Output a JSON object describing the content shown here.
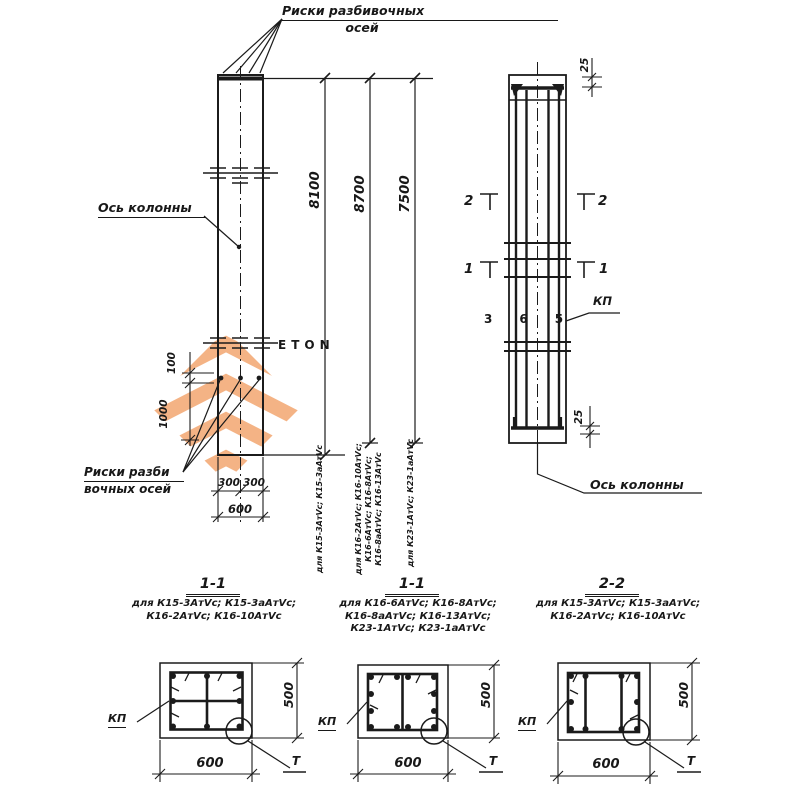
{
  "watermark": {
    "brand_word": "ETON",
    "brand_number": "365",
    "orange": "#f2a36b",
    "gray": "#bababa"
  },
  "front_view": {
    "riski_top_label_line1": "Риски разбивочных",
    "riski_top_label_line2": "осей",
    "axis_label": "Ось колонны",
    "riski_bottom_label_line1": "Риски разби",
    "riski_bottom_label_line2": "вочных осей",
    "dim_100": "100",
    "dim_1000": "1000",
    "dim_300_left": "300",
    "dim_300_right": "300",
    "dim_600": "600",
    "length_dims": [
      {
        "value": "8100",
        "note": "для К15-3АтVс; К15-3аАтVс"
      },
      {
        "value": "8700",
        "note": "для К16-2АтVс; К16-10АтVс;\nК16-6АтVс; К16-8АтVс;\nК16-8аАтVс; К16-13АтVс"
      },
      {
        "value": "7500",
        "note": "для К23-1АтVс; К23-1аАтVс"
      }
    ]
  },
  "rebar_view": {
    "dim_25_top": "25",
    "dim_25_bottom": "25",
    "section_mark_upper": "2",
    "section_mark_lower": "1",
    "kp_label": "КП",
    "axis_label": "Ось колонны"
  },
  "sections": [
    {
      "title": "1-1",
      "applies_to": "для К15-3АтVс; К15-3аАтVс;\nК16-2АтVс; К16-10АтVс",
      "kp": "КП",
      "detail": "Т",
      "width_dim": "600",
      "height_dim": "500"
    },
    {
      "title": "1-1",
      "applies_to": "для К16-6АтVс; К16-8АтVс;\nК16-8аАтVс; К16-13АтVс;\nК23-1АтVс; К23-1аАтVс",
      "kp": "КП",
      "detail": "Т",
      "width_dim": "600",
      "height_dim": "500"
    },
    {
      "title": "2-2",
      "applies_to": "для К15-3АтVс; К15-3аАтVс;\nК16-2АтVс; К16-10АтVс",
      "kp": "КП",
      "detail": "Т",
      "width_dim": "600",
      "height_dim": "500"
    }
  ]
}
